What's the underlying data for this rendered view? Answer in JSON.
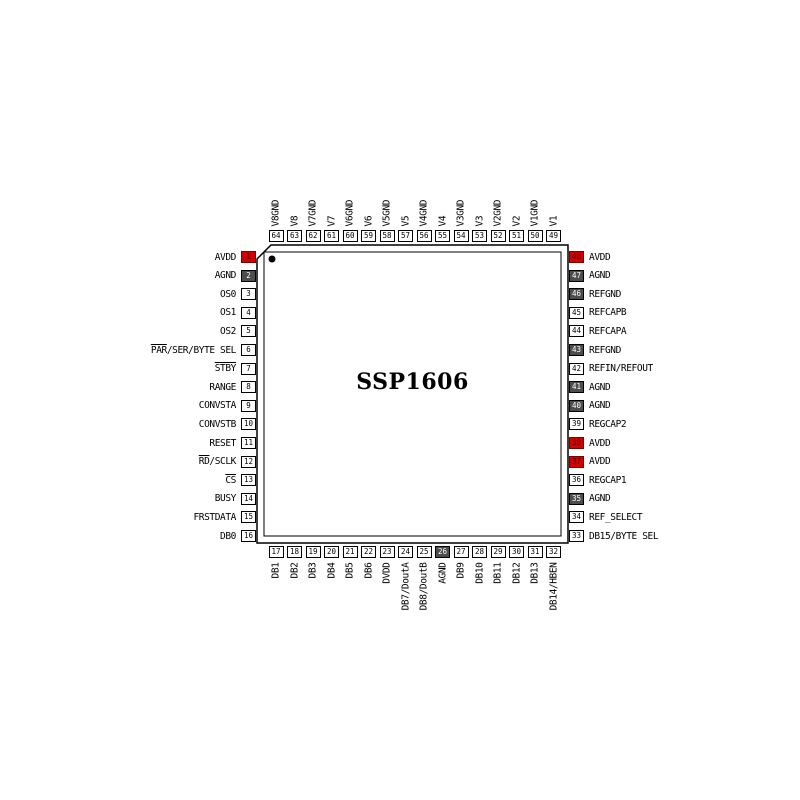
{
  "title": "SSP1606",
  "colors": {
    "pin_red": "#d40000",
    "pin_dark": "#4d4d4d",
    "pin_body_outline": "#000000",
    "background": "#ffffff"
  },
  "pins": {
    "left": [
      {
        "n": 1,
        "label": "AVDD",
        "style": "red"
      },
      {
        "n": 2,
        "label": "AGND",
        "style": "dark"
      },
      {
        "n": 3,
        "label": "OS0",
        "style": "white"
      },
      {
        "n": 4,
        "label": "OS1",
        "style": "white"
      },
      {
        "n": 5,
        "label": "OS2",
        "style": "white"
      },
      {
        "n": 6,
        "label": "PAR/SER/BYTE SEL",
        "style": "white",
        "overline": "PAR"
      },
      {
        "n": 7,
        "label": "STBY",
        "style": "white",
        "overline": "STBY"
      },
      {
        "n": 8,
        "label": "RANGE",
        "style": "white"
      },
      {
        "n": 9,
        "label": "CONVSTA",
        "style": "white"
      },
      {
        "n": 10,
        "label": "CONVSTB",
        "style": "white"
      },
      {
        "n": 11,
        "label": "RESET",
        "style": "white"
      },
      {
        "n": 12,
        "label": "RD/SCLK",
        "style": "white",
        "overline": "RD"
      },
      {
        "n": 13,
        "label": "CS",
        "style": "white",
        "overline": "CS"
      },
      {
        "n": 14,
        "label": "BUSY",
        "style": "white"
      },
      {
        "n": 15,
        "label": "FRSTDATA",
        "style": "white"
      },
      {
        "n": 16,
        "label": "DB0",
        "style": "white"
      }
    ],
    "bottom": [
      {
        "n": 17,
        "label": "DB1",
        "style": "white"
      },
      {
        "n": 18,
        "label": "DB2",
        "style": "white"
      },
      {
        "n": 19,
        "label": "DB3",
        "style": "white"
      },
      {
        "n": 20,
        "label": "DB4",
        "style": "white"
      },
      {
        "n": 21,
        "label": "DB5",
        "style": "white"
      },
      {
        "n": 22,
        "label": "DB6",
        "style": "white"
      },
      {
        "n": 23,
        "label": "DVDD",
        "style": "white"
      },
      {
        "n": 24,
        "label": "DB7/DoutA",
        "style": "white"
      },
      {
        "n": 25,
        "label": "DB8/DoutB",
        "style": "white"
      },
      {
        "n": 26,
        "label": "AGND",
        "style": "dark"
      },
      {
        "n": 27,
        "label": "DB9",
        "style": "white"
      },
      {
        "n": 28,
        "label": "DB10",
        "style": "white"
      },
      {
        "n": 29,
        "label": "DB11",
        "style": "white"
      },
      {
        "n": 30,
        "label": "DB12",
        "style": "white"
      },
      {
        "n": 31,
        "label": "DB13",
        "style": "white"
      },
      {
        "n": 32,
        "label": "DB14/HBEN",
        "style": "white"
      }
    ],
    "right": [
      {
        "n": 48,
        "label": "AVDD",
        "style": "red"
      },
      {
        "n": 47,
        "label": "AGND",
        "style": "dark"
      },
      {
        "n": 46,
        "label": "REFGND",
        "style": "dark"
      },
      {
        "n": 45,
        "label": "REFCAPB",
        "style": "white"
      },
      {
        "n": 44,
        "label": "REFCAPA",
        "style": "white"
      },
      {
        "n": 43,
        "label": "REFGND",
        "style": "dark"
      },
      {
        "n": 42,
        "label": "REFIN/REFOUT",
        "style": "white"
      },
      {
        "n": 41,
        "label": "AGND",
        "style": "dark"
      },
      {
        "n": 40,
        "label": "AGND",
        "style": "dark"
      },
      {
        "n": 39,
        "label": "REGCAP2",
        "style": "white"
      },
      {
        "n": 38,
        "label": "AVDD",
        "style": "red"
      },
      {
        "n": 37,
        "label": "AVDD",
        "style": "red"
      },
      {
        "n": 36,
        "label": "REGCAP1",
        "style": "white"
      },
      {
        "n": 35,
        "label": "AGND",
        "style": "dark"
      },
      {
        "n": 34,
        "label": "REF_SELECT",
        "style": "white"
      },
      {
        "n": 33,
        "label": "DB15/BYTE SEL",
        "style": "white"
      }
    ],
    "top": [
      {
        "n": 64,
        "label": "V8GND",
        "style": "white"
      },
      {
        "n": 63,
        "label": "V8",
        "style": "white"
      },
      {
        "n": 62,
        "label": "V7GND",
        "style": "white"
      },
      {
        "n": 61,
        "label": "V7",
        "style": "white"
      },
      {
        "n": 60,
        "label": "V6GND",
        "style": "white"
      },
      {
        "n": 59,
        "label": "V6",
        "style": "white"
      },
      {
        "n": 58,
        "label": "V5GND",
        "style": "white"
      },
      {
        "n": 57,
        "label": "V5",
        "style": "white"
      },
      {
        "n": 56,
        "label": "V4GND",
        "style": "white"
      },
      {
        "n": 55,
        "label": "V4",
        "style": "white"
      },
      {
        "n": 54,
        "label": "V3GND",
        "style": "white"
      },
      {
        "n": 53,
        "label": "V3",
        "style": "white"
      },
      {
        "n": 52,
        "label": "V2GND",
        "style": "white"
      },
      {
        "n": 51,
        "label": "V2",
        "style": "white"
      },
      {
        "n": 50,
        "label": "V1GND",
        "style": "white"
      },
      {
        "n": 49,
        "label": "V1",
        "style": "white"
      }
    ]
  }
}
